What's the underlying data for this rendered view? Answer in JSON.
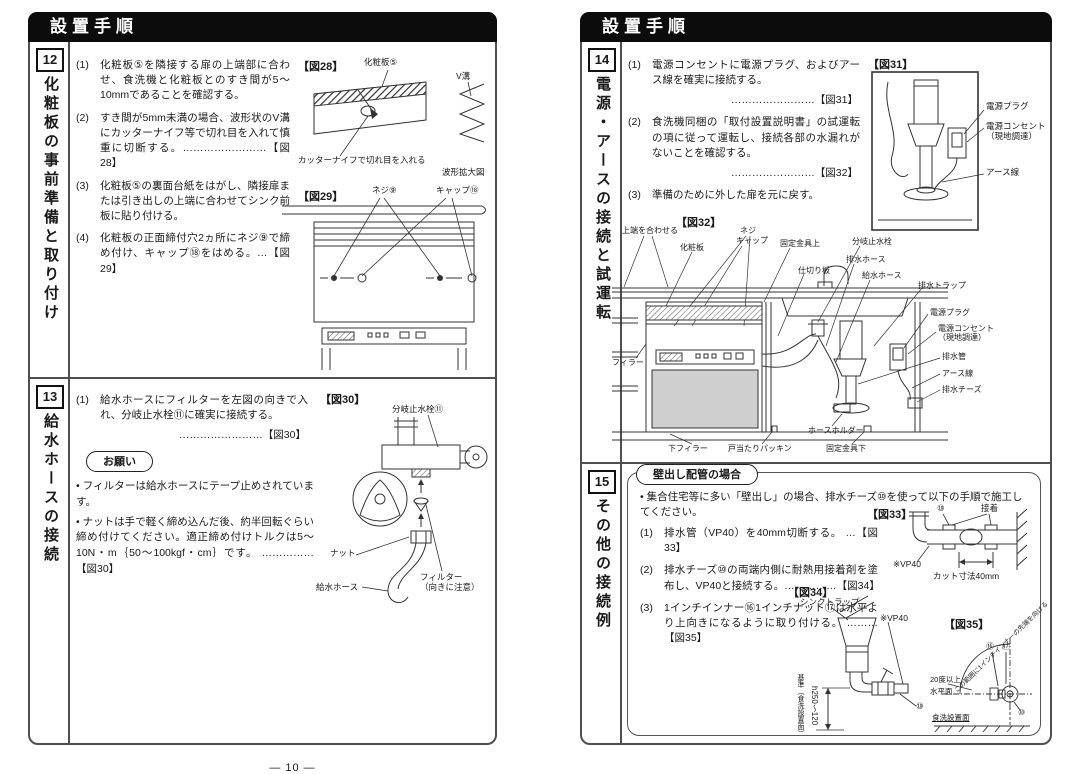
{
  "p10": {
    "header": "設置手順",
    "page_number": "— 10 —",
    "s12": {
      "num": "12",
      "title": "化粧板の事前準備と取り付け",
      "steps": [
        {
          "no": "(1)",
          "text": "化粧板⑤を隣接する扉の上端部に合わせ、食洗機と化粧板とのすき間が5～10mmであることを確認する。"
        },
        {
          "no": "(2)",
          "text": "すき間が5mm未満の場合、波形状のV溝にカッターナイフ等で切れ目を入れて慎重に切断する。……………………【図28】"
        },
        {
          "no": "(3)",
          "text": "化粧板⑤の裏面台紙をはがし、隣接扉または引き出しの上端に合わせてシンク前板に貼り付ける。"
        },
        {
          "no": "(4)",
          "text": "化粧板の正面締付穴2ヵ所にネジ⑨で締め付け、キャップ⑱をはめる。…【図29】"
        }
      ],
      "fig28": {
        "label": "【図28】",
        "panel": "化粧板⑤",
        "cut": "カッターナイフで切れ目を入れる",
        "vgroove": "V溝",
        "zoomcap": "波形拡大図"
      },
      "fig29": {
        "label": "【図29】",
        "screw": "ネジ⑨",
        "cap": "キャップ⑱"
      }
    },
    "s13": {
      "num": "13",
      "title": "給水ホースの接続",
      "step1_no": "(1)",
      "step1": "給水ホースにフィルターを左図の向きで入れ、分岐止水栓⑪に確実に接続する。",
      "step1_ref": "……………………【図30】",
      "note_title": "お願い",
      "note1": "• フィルターは給水ホースにテープ止めされています。",
      "note2": "• ナットは手で軽く締め込んだ後、約半回転ぐらい締め付けてください。適正締め付けトルクは5～10N・m｛50～100kgf・cm｝です。 ……………【図30】",
      "fig30": {
        "label": "【図30】",
        "valve": "分岐止水栓⑪",
        "nut": "ナット",
        "hose": "給水ホース",
        "filter1": "フィルター",
        "filter2": "（向きに注意）"
      }
    }
  },
  "p11": {
    "header": "設置手順",
    "page_number": "— 11 —",
    "s14": {
      "num": "14",
      "title": "電源・アースの接続と試運転",
      "steps": [
        {
          "no": "(1)",
          "text": "電源コンセントに電源プラグ、およびアース線を確実に接続する。",
          "ref": "……………………【図31】"
        },
        {
          "no": "(2)",
          "text": "食洗機同梱の「取付設置説明書」の試運転の項に従って運転し、接続各部の水漏れがないことを確認する。",
          "ref": "……………………【図32】"
        },
        {
          "no": "(3)",
          "text": "準備のために外した扉を元に戻す。",
          "ref": ""
        }
      ],
      "fig31": {
        "label": "【図31】",
        "plug": "電源プラグ",
        "outlet1": "電源コンセント",
        "outlet2": "（現地調達）",
        "earth": "アース線"
      },
      "fig32": {
        "label": "【図32】",
        "align_top": "上端を合わせる",
        "screw": "ネジ",
        "cap": "キャップ",
        "panel": "化粧板",
        "bracket_top": "固定金具上",
        "divider": "仕切り板",
        "valve": "分岐止水栓",
        "drain_hose": "排水ホース",
        "supply_hose": "給水ホース",
        "trap": "排水トラップ",
        "plug": "電源プラグ",
        "outlet1": "電源コンセント",
        "outlet2": "（現地調達）",
        "drain_pipe": "排水管",
        "earth": "アース線",
        "tee": "排水チーズ",
        "holder": "ホースホルダー",
        "filler": "フィラー",
        "lower_filler": "下フィラー",
        "packing": "戸当たりパッキン",
        "bracket_bottom": "固定金具下"
      }
    },
    "s15": {
      "num": "15",
      "title": "その他の接続例",
      "box_title": "壁出し配管の場合",
      "intro": "• 集合住宅等に多い「壁出し」の場合、排水チーズ⑩を使って以下の手順で施工してください。",
      "steps": [
        {
          "no": "(1)",
          "text": "排水管（VP40）を40mm切断する。 …【図33】"
        },
        {
          "no": "(2)",
          "text": "排水チーズ⑩の両端内側に耐熱用接着剤を塗布し、VP40と接続する。……………【図34】"
        },
        {
          "no": "(3)",
          "text": "1インチインナー⑯1インチナット⑰は水平より上向きになるように取り付ける。 ………【図35】"
        }
      ],
      "fig33": {
        "label": "【図33】",
        "tee_num": "⑩",
        "glue": "接着",
        "vp40": "※VP40",
        "cut_dim": "カット寸法40mm"
      },
      "fig34": {
        "label": "【図34】",
        "sink_trap": "シンクトラップ",
        "vp40": "※VP40",
        "tee_num": "⑩",
        "dim": "h250～120",
        "base": "基準（食洗設置面）"
      },
      "fig35": {
        "label": "【図35】",
        "range": "この範囲に1インチインナーの先端を向ける",
        "n16": "⑯",
        "n17": "⑰",
        "angle": "20度以上",
        "horiz": "水平面",
        "base": "食洗設置面",
        "n10": "⑩"
      }
    }
  }
}
